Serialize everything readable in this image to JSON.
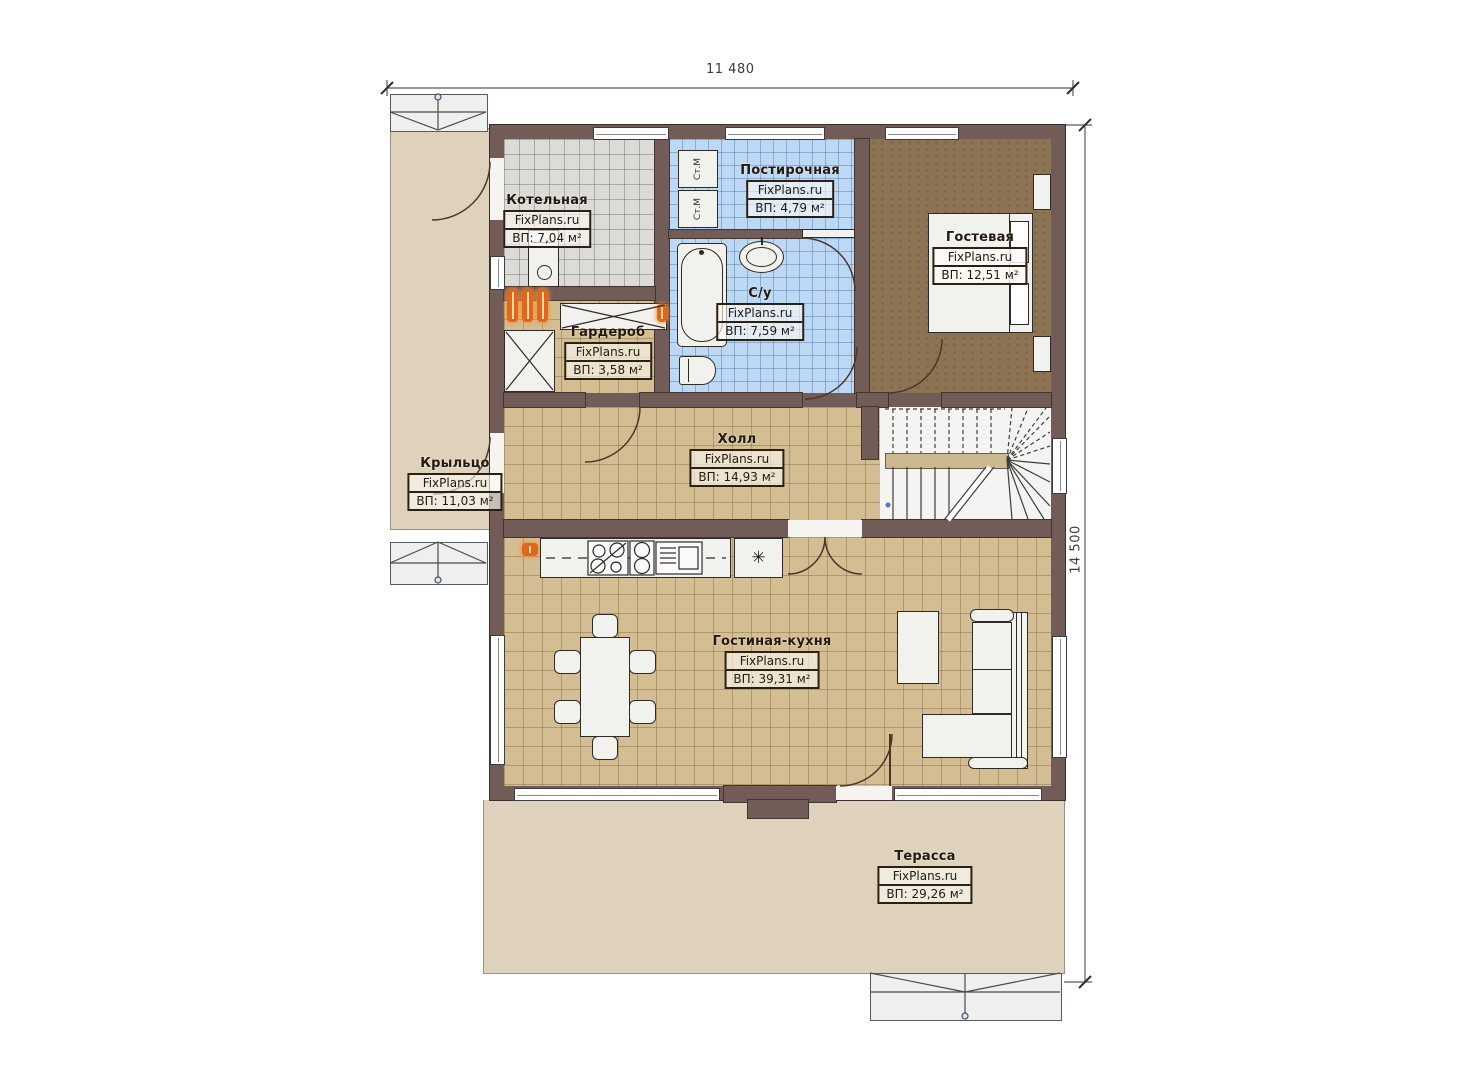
{
  "brand": "FixPlans.ru",
  "dimensions": {
    "width": "11 480",
    "height": "14 500"
  },
  "rooms": [
    {
      "key": "kotelnaya",
      "name": "Котельная",
      "brand": "FixPlans.ru",
      "area": "ВП: 7,04 м²"
    },
    {
      "key": "postirochnaya",
      "name": "Постирочная",
      "brand": "FixPlans.ru",
      "area": "ВП: 4,79 м²"
    },
    {
      "key": "gostevaya",
      "name": "Гостевая",
      "brand": "FixPlans.ru",
      "area": "ВП: 12,51 м²"
    },
    {
      "key": "su",
      "name": "С/у",
      "brand": "FixPlans.ru",
      "area": "ВП: 7,59 м²"
    },
    {
      "key": "garderob",
      "name": "Гардероб",
      "brand": "FixPlans.ru",
      "area": "ВП: 3,58 м²"
    },
    {
      "key": "holl",
      "name": "Холл",
      "brand": "FixPlans.ru",
      "area": "ВП: 14,93 м²"
    },
    {
      "key": "krylco",
      "name": "Крыльцо",
      "brand": "FixPlans.ru",
      "area": "ВП: 11,03 м²"
    },
    {
      "key": "gostinaya",
      "name": "Гостиная-кухня",
      "brand": "FixPlans.ru",
      "area": "ВП: 39,31 м²"
    },
    {
      "key": "terassa",
      "name": "Терасса",
      "brand": "FixPlans.ru",
      "area": "ВП: 29,26 м²"
    }
  ],
  "appliances": {
    "washer_label": "Ст.М",
    "fridge_symbol": "✳"
  }
}
